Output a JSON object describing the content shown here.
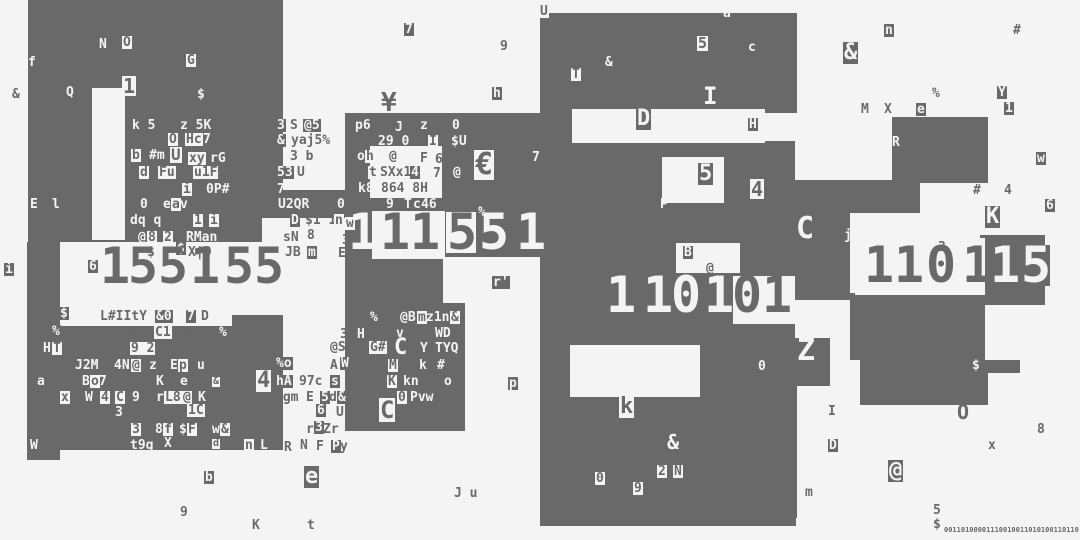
{
  "meta": {
    "width": 1080,
    "height": 540,
    "colors": {
      "bg": "#f4f4f4",
      "dark": "#696969",
      "light": "#f4f4f4"
    }
  },
  "blocks": {
    "dark": [
      [
        28,
        0,
        255,
        242
      ],
      [
        276,
        190,
        79,
        28
      ],
      [
        27,
        242,
        33,
        218
      ],
      [
        55,
        326,
        228,
        24
      ],
      [
        55,
        350,
        228,
        100
      ],
      [
        230,
        308,
        53,
        42
      ],
      [
        345,
        113,
        195,
        190
      ],
      [
        345,
        303,
        120,
        128
      ],
      [
        540,
        13,
        257,
        100
      ],
      [
        540,
        113,
        95,
        413
      ],
      [
        635,
        141,
        160,
        134
      ],
      [
        595,
        245,
        200,
        100
      ],
      [
        635,
        345,
        161,
        181
      ],
      [
        892,
        117,
        96,
        66
      ],
      [
        795,
        180,
        125,
        33
      ],
      [
        795,
        196,
        55,
        104
      ],
      [
        980,
        235,
        65,
        70
      ],
      [
        850,
        293,
        135,
        67
      ],
      [
        793,
        338,
        37,
        48
      ],
      [
        720,
        360,
        77,
        158
      ],
      [
        860,
        360,
        160,
        13
      ],
      [
        860,
        373,
        128,
        32
      ]
    ],
    "light": [
      [
        92,
        88,
        33,
        152
      ],
      [
        60,
        253,
        230,
        62
      ],
      [
        262,
        218,
        83,
        90
      ],
      [
        60,
        308,
        172,
        18
      ],
      [
        370,
        146,
        72,
        52
      ],
      [
        372,
        211,
        73,
        48
      ],
      [
        443,
        257,
        97,
        46
      ],
      [
        572,
        109,
        193,
        34
      ],
      [
        662,
        157,
        62,
        46
      ],
      [
        676,
        243,
        64,
        30
      ],
      [
        570,
        345,
        130,
        52
      ],
      [
        855,
        238,
        130,
        57
      ],
      [
        733,
        276,
        62,
        48
      ]
    ]
  },
  "numbers": [
    {
      "name": "left-number",
      "y": 250,
      "size": 50,
      "digits": [
        {
          "x": 100,
          "d": "1",
          "c": "d"
        },
        {
          "x": 128,
          "d": "5",
          "c": "d"
        },
        {
          "x": 158,
          "d": "5",
          "c": "d"
        },
        {
          "x": 190,
          "d": "1",
          "c": "d"
        },
        {
          "x": 224,
          "d": "5",
          "c": "d"
        },
        {
          "x": 254,
          "d": "5",
          "c": "d"
        }
      ]
    },
    {
      "name": "mid-number",
      "y": 216,
      "size": 50,
      "digits": [
        {
          "x": 348,
          "d": "1",
          "c": "w"
        },
        {
          "x": 380,
          "d": "1",
          "c": "d"
        },
        {
          "x": 410,
          "d": "1",
          "c": "d"
        },
        {
          "x": 446,
          "d": "5",
          "c": "dc"
        },
        {
          "x": 479,
          "d": "5",
          "c": "w"
        },
        {
          "x": 516,
          "d": "1",
          "c": "w"
        }
      ]
    },
    {
      "name": "center-number",
      "y": 279,
      "size": 50,
      "digits": [
        {
          "x": 606,
          "d": "1",
          "c": "w"
        },
        {
          "x": 643,
          "d": "1",
          "c": "w"
        },
        {
          "x": 671,
          "d": "0",
          "c": "w"
        },
        {
          "x": 704,
          "d": "1",
          "c": "w"
        },
        {
          "x": 732,
          "d": "0",
          "c": "d"
        },
        {
          "x": 762,
          "d": "1",
          "c": "d"
        }
      ]
    },
    {
      "name": "right-number",
      "y": 249,
      "size": 50,
      "digits": [
        {
          "x": 864,
          "d": "1",
          "c": "d"
        },
        {
          "x": 894,
          "d": "1",
          "c": "d"
        },
        {
          "x": 926,
          "d": "0",
          "c": "d"
        },
        {
          "x": 962,
          "d": "1",
          "c": "d"
        },
        {
          "x": 990,
          "d": "1",
          "c": "w"
        },
        {
          "x": 1020,
          "d": "5",
          "c": "wc"
        }
      ]
    }
  ],
  "glyphs": [
    [
      4,
      263,
      "i",
      "wc"
    ],
    [
      12,
      88,
      "&",
      "d"
    ],
    [
      28,
      56,
      "f",
      "w"
    ],
    [
      99,
      38,
      "N",
      "w"
    ],
    [
      122,
      36,
      "O",
      "dc"
    ],
    [
      186,
      54,
      "G",
      "dc"
    ],
    [
      66,
      86,
      "Q",
      "w"
    ],
    [
      197,
      88,
      "$",
      "w"
    ],
    [
      122,
      76,
      "1",
      "dc",
      20
    ],
    [
      132,
      119,
      "k 5",
      "w"
    ],
    [
      180,
      119,
      "z 5K",
      "w"
    ],
    [
      168,
      133,
      "O",
      "dc"
    ],
    [
      185,
      133,
      "Hc",
      "dc"
    ],
    [
      203,
      133,
      "7",
      "w"
    ],
    [
      131,
      149,
      "b",
      "dc"
    ],
    [
      149,
      149,
      "#m",
      "w"
    ],
    [
      170,
      147,
      "U",
      "dc",
      16
    ],
    [
      188,
      152,
      "xy",
      "dc"
    ],
    [
      210,
      152,
      "rG",
      "w"
    ],
    [
      139,
      166,
      "d",
      "dc"
    ],
    [
      158,
      166,
      "Fu",
      "dc"
    ],
    [
      193,
      166,
      "u1F",
      "dc"
    ],
    [
      126,
      176,
      "S",
      "d",
      22
    ],
    [
      182,
      183,
      "i",
      "dc"
    ],
    [
      206,
      183,
      "0P#",
      "w"
    ],
    [
      277,
      183,
      "7",
      "w"
    ],
    [
      30,
      198,
      "E",
      "w"
    ],
    [
      52,
      198,
      "l",
      "w"
    ],
    [
      140,
      198,
      "0",
      "w"
    ],
    [
      163,
      198,
      "e",
      "w"
    ],
    [
      171,
      198,
      "a",
      "dc"
    ],
    [
      180,
      198,
      "v",
      "w"
    ],
    [
      130,
      214,
      "dq q",
      "w"
    ],
    [
      193,
      214,
      "1",
      "dc"
    ],
    [
      209,
      214,
      "i",
      "dc"
    ],
    [
      138,
      231,
      "@",
      "w"
    ],
    [
      147,
      231,
      "8",
      "dc"
    ],
    [
      163,
      231,
      "2",
      "dc"
    ],
    [
      186,
      231,
      "RMan",
      "w"
    ],
    [
      278,
      198,
      "U2QR",
      "w"
    ],
    [
      337,
      198,
      "0",
      "w"
    ],
    [
      290,
      214,
      "D",
      "wc"
    ],
    [
      305,
      214,
      "$1 1",
      "d"
    ],
    [
      334,
      214,
      "n",
      "dc"
    ],
    [
      345,
      217,
      "w",
      "dc"
    ],
    [
      283,
      231,
      "sN",
      "d"
    ],
    [
      307,
      229,
      "8",
      "d"
    ],
    [
      285,
      246,
      "JB",
      "d"
    ],
    [
      307,
      246,
      "m",
      "wc"
    ],
    [
      342,
      234,
      "3",
      "d"
    ],
    [
      338,
      247,
      "E4]Y",
      "d"
    ],
    [
      147,
      246,
      "$",
      "d"
    ],
    [
      176,
      242,
      "$",
      "wc"
    ],
    [
      188,
      246,
      "X|D",
      "d"
    ],
    [
      88,
      260,
      "6",
      "wc"
    ],
    [
      276,
      119,
      "3",
      "wc"
    ],
    [
      290,
      119,
      "S",
      "d"
    ],
    [
      303,
      119,
      "@5",
      "wc"
    ],
    [
      276,
      134,
      "&",
      "wc"
    ],
    [
      290,
      134,
      "yaj5%",
      "dc"
    ],
    [
      290,
      150,
      "3 b",
      "d"
    ],
    [
      276,
      166,
      "53",
      "wc"
    ],
    [
      297,
      166,
      "U",
      "d"
    ],
    [
      59,
      307,
      "$",
      "wc"
    ],
    [
      100,
      310,
      "L#IItY",
      "d"
    ],
    [
      155,
      310,
      "&0",
      "wc"
    ],
    [
      186,
      310,
      "7",
      "wc"
    ],
    [
      201,
      310,
      "D",
      "d"
    ],
    [
      51,
      325,
      "%",
      "wc"
    ],
    [
      130,
      328,
      "L",
      "d"
    ],
    [
      154,
      326,
      "C1",
      "dc"
    ],
    [
      184,
      328,
      "%2",
      "d"
    ],
    [
      218,
      326,
      "%",
      "wc"
    ],
    [
      43,
      342,
      "H",
      "w"
    ],
    [
      52,
      342,
      "T",
      "dc"
    ],
    [
      130,
      342,
      "9 2",
      "dc"
    ],
    [
      180,
      342,
      "1",
      "d"
    ],
    [
      75,
      359,
      "J2M",
      "w"
    ],
    [
      114,
      359,
      "4N",
      "w"
    ],
    [
      131,
      359,
      "@",
      "dc"
    ],
    [
      149,
      359,
      "z",
      "w"
    ],
    [
      170,
      359,
      "E",
      "w"
    ],
    [
      178,
      359,
      "p",
      "dc"
    ],
    [
      196,
      359,
      "u",
      "wc"
    ],
    [
      210,
      359,
      "Sb",
      "d"
    ],
    [
      37,
      375,
      "a",
      "w"
    ],
    [
      82,
      375,
      "B",
      "w"
    ],
    [
      90,
      375,
      "o",
      "dc"
    ],
    [
      99,
      375,
      "7",
      "w"
    ],
    [
      156,
      375,
      "K",
      "w"
    ],
    [
      180,
      375,
      "e",
      "w"
    ],
    [
      212,
      377,
      "&",
      "dc",
      10
    ],
    [
      256,
      370,
      "4",
      "dc",
      22
    ],
    [
      60,
      391,
      "x",
      "dc"
    ],
    [
      85,
      391,
      "W",
      "w"
    ],
    [
      100,
      391,
      "4",
      "dc"
    ],
    [
      115,
      391,
      "C",
      "dc"
    ],
    [
      132,
      391,
      "9",
      "w"
    ],
    [
      156,
      391,
      "r",
      "w"
    ],
    [
      164,
      391,
      "L8",
      "dc"
    ],
    [
      182,
      391,
      "@",
      "dc"
    ],
    [
      198,
      391,
      "K",
      "w"
    ],
    [
      115,
      406,
      "3",
      "w"
    ],
    [
      187,
      404,
      "1C",
      "dc"
    ],
    [
      131,
      423,
      "3",
      "dc"
    ],
    [
      155,
      423,
      "8",
      "w"
    ],
    [
      163,
      423,
      "f",
      "dc"
    ],
    [
      179,
      423,
      "$",
      "w"
    ],
    [
      187,
      423,
      "F",
      "dc"
    ],
    [
      212,
      423,
      "w",
      "w"
    ],
    [
      220,
      423,
      "&",
      "dc"
    ],
    [
      130,
      439,
      "t9g",
      "w"
    ],
    [
      164,
      437,
      "X",
      "w"
    ],
    [
      212,
      439,
      "d",
      "dc",
      10
    ],
    [
      244,
      439,
      "n",
      "dc"
    ],
    [
      260,
      439,
      "L",
      "w"
    ],
    [
      29,
      439,
      "W",
      "wc"
    ],
    [
      236,
      455,
      "2",
      "w"
    ],
    [
      204,
      471,
      "b",
      "wc"
    ],
    [
      304,
      466,
      "e",
      "wc",
      22
    ],
    [
      180,
      506,
      "9",
      "d"
    ],
    [
      252,
      519,
      "K",
      "d"
    ],
    [
      307,
      519,
      "t",
      "d"
    ],
    [
      275,
      357,
      "%o",
      "wc"
    ],
    [
      330,
      359,
      "A",
      "d"
    ],
    [
      340,
      357,
      "W",
      "wc"
    ],
    [
      275,
      375,
      "hA",
      "wc"
    ],
    [
      299,
      375,
      "97c",
      "d"
    ],
    [
      330,
      375,
      "s",
      "wc"
    ],
    [
      275,
      391,
      "sgm",
      "d"
    ],
    [
      306,
      391,
      "E",
      "d"
    ],
    [
      320,
      391,
      "5",
      "wc"
    ],
    [
      329,
      391,
      "d",
      "d"
    ],
    [
      337,
      391,
      "&",
      "wc"
    ],
    [
      275,
      406,
      "A",
      "d"
    ],
    [
      316,
      404,
      "6",
      "wc"
    ],
    [
      336,
      406,
      "U C",
      "d"
    ],
    [
      306,
      423,
      "r",
      "d"
    ],
    [
      314,
      421,
      "3",
      "wc"
    ],
    [
      323,
      423,
      "Zr",
      "d"
    ],
    [
      284,
      441,
      "R",
      "d"
    ],
    [
      300,
      439,
      "N",
      "d"
    ],
    [
      316,
      440,
      "F",
      "d"
    ],
    [
      331,
      440,
      "P",
      "wc"
    ],
    [
      340,
      440,
      "y",
      "d"
    ],
    [
      404,
      23,
      "7",
      "wc"
    ],
    [
      500,
      40,
      "9",
      "d"
    ],
    [
      381,
      90,
      "¥",
      "d",
      26
    ],
    [
      492,
      87,
      "h",
      "wc"
    ],
    [
      539,
      5,
      "U",
      "dc"
    ],
    [
      723,
      7,
      "a",
      "w"
    ],
    [
      697,
      36,
      "5",
      "dc",
      15
    ],
    [
      605,
      56,
      "&",
      "w"
    ],
    [
      571,
      68,
      "T",
      "dc"
    ],
    [
      703,
      84,
      "I",
      "w",
      24
    ],
    [
      748,
      41,
      "c",
      "w"
    ],
    [
      355,
      119,
      "p6",
      "w"
    ],
    [
      395,
      121,
      "J",
      "w"
    ],
    [
      420,
      119,
      "z",
      "w"
    ],
    [
      452,
      119,
      "0",
      "w"
    ],
    [
      378,
      135,
      "29 0",
      "w"
    ],
    [
      428,
      135,
      "I",
      "dc"
    ],
    [
      451,
      135,
      "$U",
      "w"
    ],
    [
      357,
      150,
      "o",
      "w"
    ],
    [
      365,
      150,
      "h",
      "dc"
    ],
    [
      389,
      150,
      "@",
      "d"
    ],
    [
      420,
      152,
      "F",
      "d"
    ],
    [
      435,
      153,
      "6",
      "d"
    ],
    [
      368,
      166,
      "t",
      "dc"
    ],
    [
      380,
      166,
      "SXx1",
      "d"
    ],
    [
      410,
      166,
      "4",
      "wc"
    ],
    [
      433,
      167,
      "7",
      "d"
    ],
    [
      452,
      166,
      "@",
      "wc"
    ],
    [
      358,
      182,
      "k8",
      "w"
    ],
    [
      381,
      182,
      "864 8H",
      "d"
    ],
    [
      385,
      198,
      "9",
      "wc"
    ],
    [
      404,
      198,
      "T",
      "w"
    ],
    [
      412,
      198,
      "c",
      "wc"
    ],
    [
      421,
      198,
      "46",
      "w"
    ],
    [
      509,
      197,
      "%",
      "d"
    ],
    [
      478,
      206,
      "%",
      "w"
    ],
    [
      474,
      150,
      "€",
      "dc",
      30
    ],
    [
      532,
      151,
      "7",
      "w"
    ],
    [
      492,
      276,
      "r'",
      "wc"
    ],
    [
      370,
      311,
      "%",
      "w"
    ],
    [
      400,
      311,
      "@B",
      "w"
    ],
    [
      417,
      311,
      "m",
      "dc"
    ],
    [
      426,
      311,
      "z1n",
      "w"
    ],
    [
      450,
      311,
      "&",
      "dc"
    ],
    [
      396,
      327,
      "v",
      "w"
    ],
    [
      435,
      327,
      "WD",
      "w"
    ],
    [
      340,
      328,
      "3d",
      "d"
    ],
    [
      356,
      328,
      "H",
      "wc"
    ],
    [
      330,
      341,
      "@S",
      "d"
    ],
    [
      369,
      341,
      "G#",
      "dc"
    ],
    [
      394,
      337,
      "C",
      "w",
      22
    ],
    [
      420,
      342,
      "Y",
      "w"
    ],
    [
      435,
      342,
      "TYQ",
      "w"
    ],
    [
      378,
      359,
      "3",
      "d"
    ],
    [
      388,
      359,
      "M",
      "dc"
    ],
    [
      419,
      359,
      "k",
      "w"
    ],
    [
      436,
      359,
      "#",
      "wc"
    ],
    [
      387,
      375,
      "K",
      "dc"
    ],
    [
      403,
      375,
      "kn",
      "w"
    ],
    [
      444,
      375,
      "o",
      "w"
    ],
    [
      508,
      377,
      "p",
      "wc"
    ],
    [
      397,
      391,
      "0",
      "dc"
    ],
    [
      410,
      391,
      "Pvw",
      "w"
    ],
    [
      452,
      393,
      "%",
      "d"
    ],
    [
      379,
      398,
      "C",
      "dc",
      24
    ],
    [
      454,
      487,
      "J u",
      "d"
    ],
    [
      636,
      108,
      "D",
      "wc",
      22
    ],
    [
      748,
      118,
      "H",
      "wc"
    ],
    [
      788,
      121,
      "s",
      "w"
    ],
    [
      892,
      136,
      "R",
      "w"
    ],
    [
      884,
      24,
      "n",
      "wc"
    ],
    [
      1013,
      24,
      "#",
      "d"
    ],
    [
      843,
      42,
      "&",
      "wc",
      22
    ],
    [
      932,
      87,
      "%",
      "d"
    ],
    [
      997,
      86,
      "Y",
      "wc"
    ],
    [
      1004,
      102,
      "1",
      "wc"
    ],
    [
      861,
      103,
      "M",
      "d"
    ],
    [
      884,
      103,
      "X",
      "d"
    ],
    [
      916,
      103,
      "e",
      "wc"
    ],
    [
      1036,
      152,
      "w",
      "wc"
    ],
    [
      750,
      179,
      "4",
      "dc",
      20
    ],
    [
      973,
      184,
      "#",
      "d"
    ],
    [
      1004,
      184,
      "4",
      "d"
    ],
    [
      1045,
      199,
      "6",
      "wc"
    ],
    [
      844,
      200,
      "A",
      "d"
    ],
    [
      698,
      163,
      "5",
      "wc",
      22
    ],
    [
      660,
      198,
      "P",
      "w"
    ],
    [
      844,
      229,
      "j",
      "w"
    ],
    [
      796,
      214,
      "C",
      "w",
      30
    ],
    [
      985,
      206,
      "K",
      "wc",
      22
    ],
    [
      683,
      246,
      "B",
      "wc"
    ],
    [
      706,
      262,
      "@",
      "d"
    ],
    [
      938,
      241,
      "3",
      "d"
    ],
    [
      758,
      360,
      "0",
      "w"
    ],
    [
      797,
      336,
      "Z",
      "w",
      30
    ],
    [
      972,
      359,
      "$",
      "w"
    ],
    [
      828,
      405,
      "I",
      "d"
    ],
    [
      957,
      402,
      "O",
      "d",
      20
    ],
    [
      1037,
      423,
      "8",
      "d"
    ],
    [
      828,
      439,
      "D",
      "wc"
    ],
    [
      988,
      439,
      "x",
      "d"
    ],
    [
      888,
      460,
      "@",
      "wc",
      22
    ],
    [
      805,
      486,
      "m",
      "d"
    ],
    [
      933,
      504,
      "5",
      "d"
    ],
    [
      933,
      518,
      "$",
      "d"
    ],
    [
      619,
      396,
      "k",
      "dc",
      22
    ],
    [
      667,
      432,
      "&",
      "w",
      20
    ],
    [
      595,
      472,
      "0",
      "dc"
    ],
    [
      657,
      465,
      "2",
      "dc"
    ],
    [
      673,
      465,
      "N",
      "dc"
    ],
    [
      633,
      482,
      "9",
      "dc"
    ]
  ],
  "ticker": {
    "x": 944,
    "y": 526,
    "size": 7,
    "text": "00110100001110010011010100110110"
  }
}
